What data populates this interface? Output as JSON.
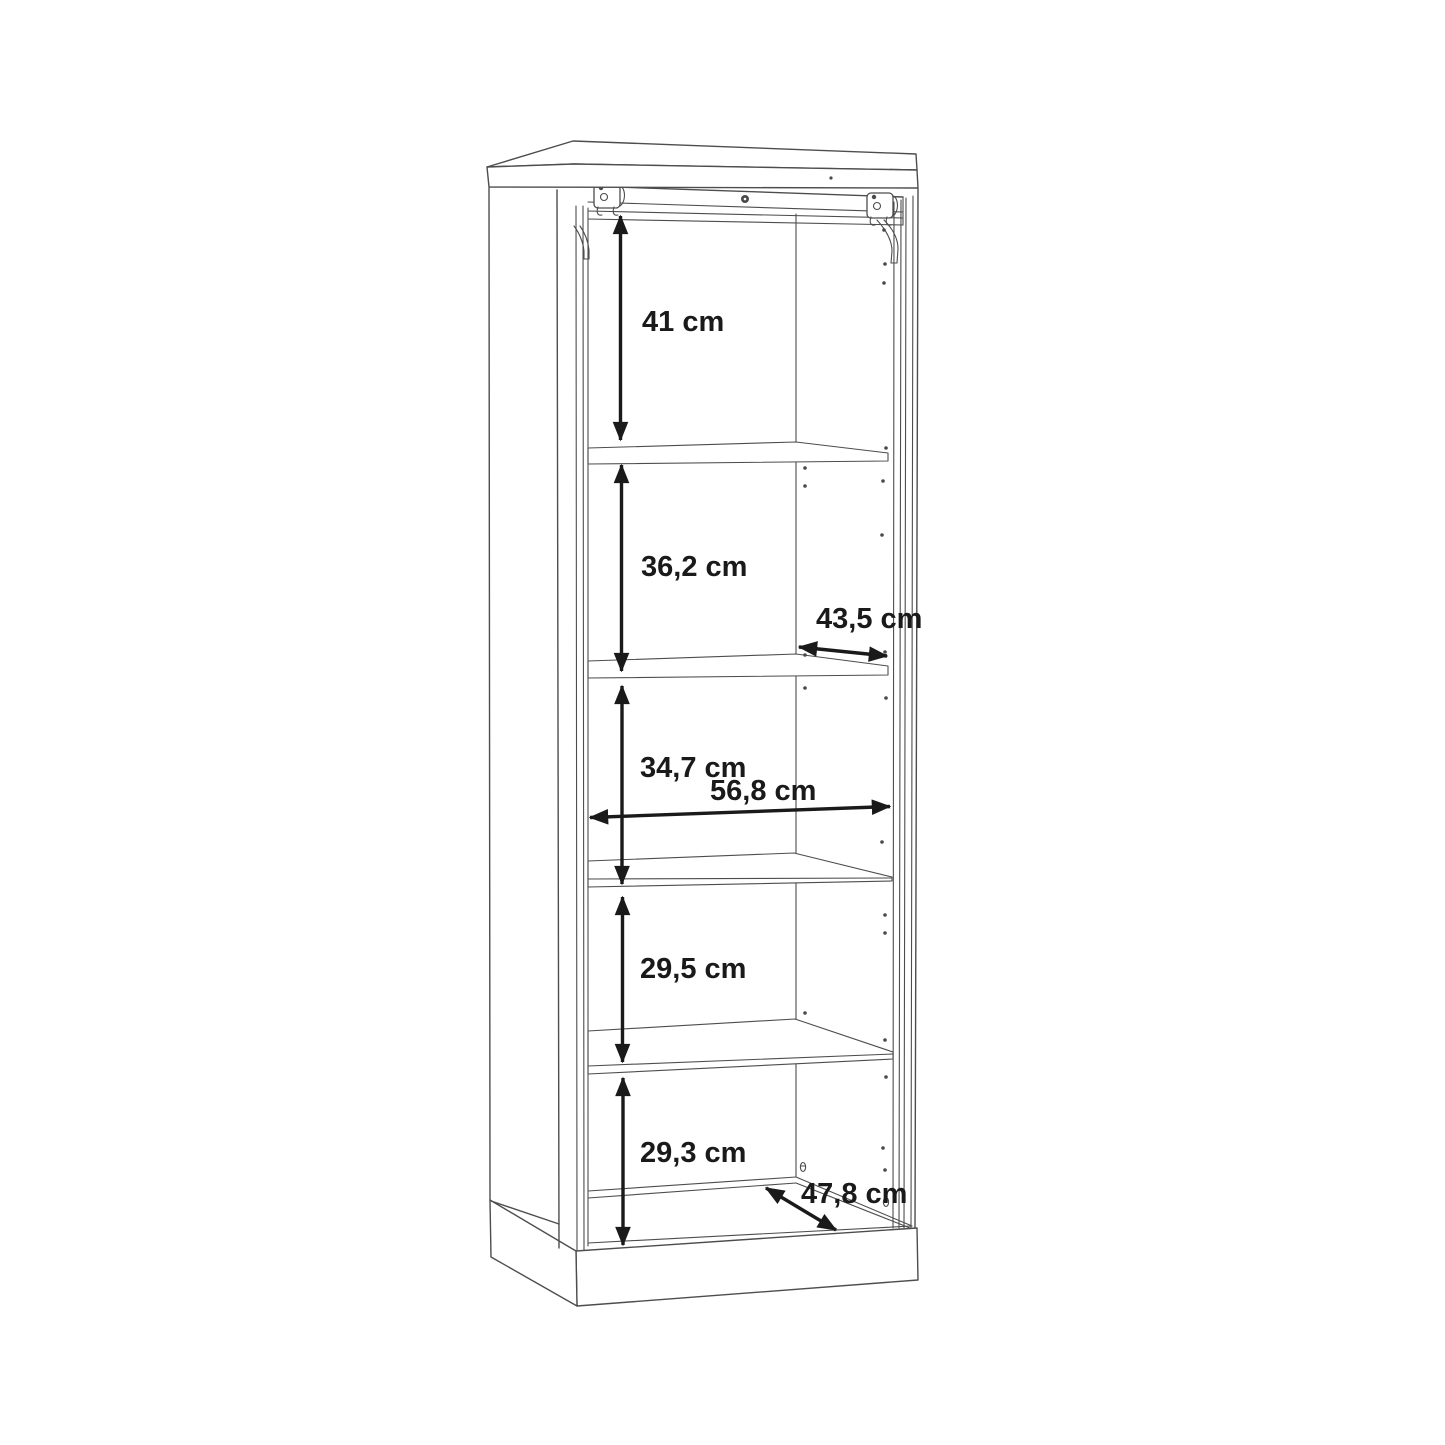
{
  "diagram": {
    "type": "furniture-dimension-drawing",
    "unit": "cm",
    "background_color": "#ffffff",
    "line_color": "#4d4d4d",
    "dimension_color": "#1a1a1a",
    "labels": {
      "section1_height": "41 cm",
      "section2_height": "36,2 cm",
      "shelf_depth": "43,5 cm",
      "section3_height": "34,7 cm",
      "interior_width": "56,8 cm",
      "section4_height": "29,5 cm",
      "section5_height": "29,3 cm",
      "base_depth": "47,8 cm"
    }
  }
}
